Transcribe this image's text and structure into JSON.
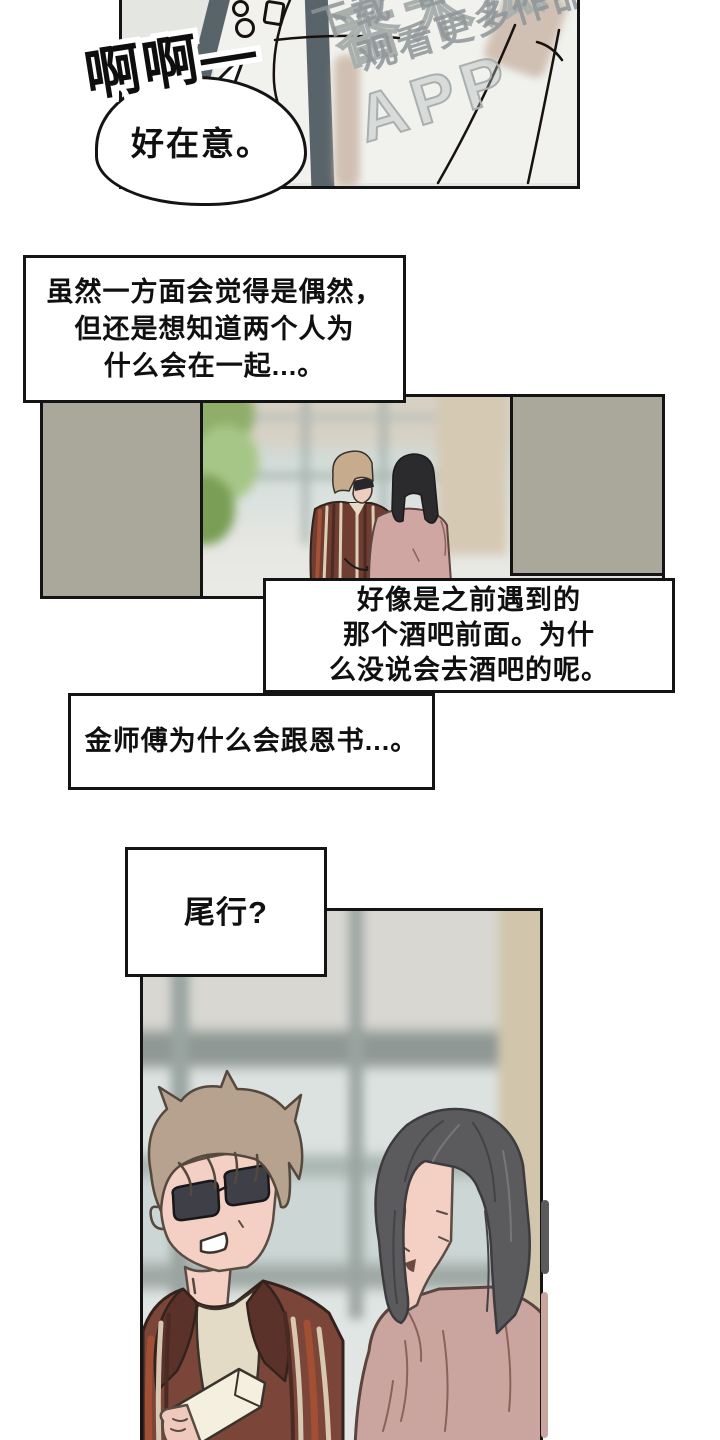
{
  "watermark": {
    "big_text": "番木瓜APP",
    "line1": "下载“番木瓜”",
    "line2": "观看更多作品",
    "color": "#8f9598"
  },
  "sfx": {
    "text": "啊啊—"
  },
  "bubble": {
    "text": "好在意。"
  },
  "box1": {
    "line1": "虽然一方面会觉得是偶然，",
    "line2": "但还是想知道两个人为",
    "line3": "什么会在一起...。"
  },
  "box2": {
    "line1": "好像是之前遇到的",
    "line2": "那个酒吧前面。为什",
    "line3": "么没说会去酒吧的呢。"
  },
  "box3": {
    "line1": "金师傅为什么会跟恩书...。"
  },
  "box4": {
    "line1": "尾行?"
  },
  "colors": {
    "ink": "#141414",
    "panel_bg": "#e4e6e1",
    "pillar": "#a9a89b",
    "strap": "#59646a",
    "jacket": "#7b4639",
    "stripe_cream": "#ddcfb8",
    "stripe_rust": "#a24f34",
    "hair_brown": "#b6a28e",
    "hair_black": "#5b5b5e",
    "shirt_pink": "#caa59f",
    "skin": "#f3d0c3",
    "curtain": "#d1c6ac"
  }
}
